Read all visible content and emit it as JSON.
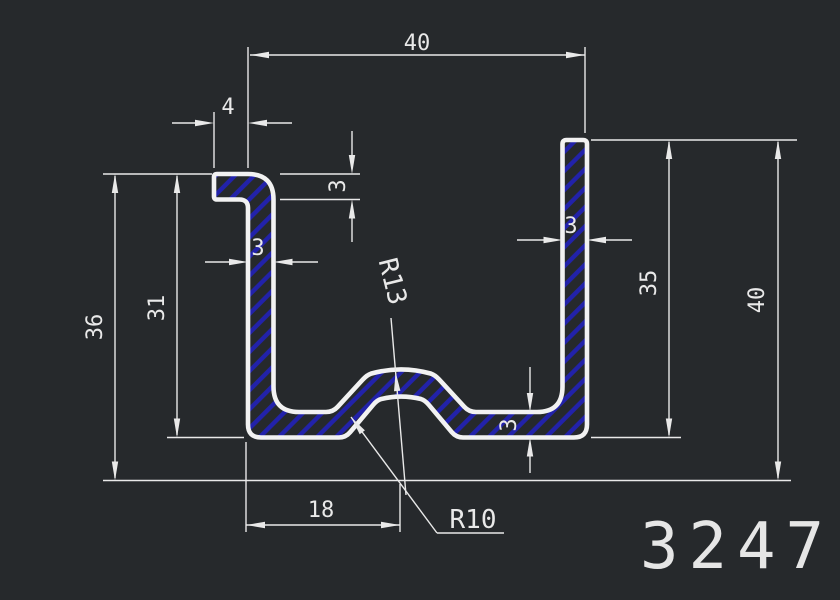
{
  "canvas": {
    "background": "#26292c",
    "line_color": "#e9e9e9",
    "profile_line_color": "#f2f2f2",
    "hatch_color": "#2222aa"
  },
  "title_block": {
    "part_number": "3247"
  },
  "dimensions": {
    "overall_width": "40",
    "lip_length": "4",
    "lip_thickness": "3",
    "left_wall_thickness": "3",
    "left_wall_height": "31",
    "left_total_height": "36",
    "right_wall_thickness": "3",
    "right_wall_height": "35",
    "right_total_height": "40",
    "bottom_thickness": "3",
    "groove_center_offset": "18",
    "groove_outer_radius": "R13",
    "groove_inner_radius": "R10"
  }
}
